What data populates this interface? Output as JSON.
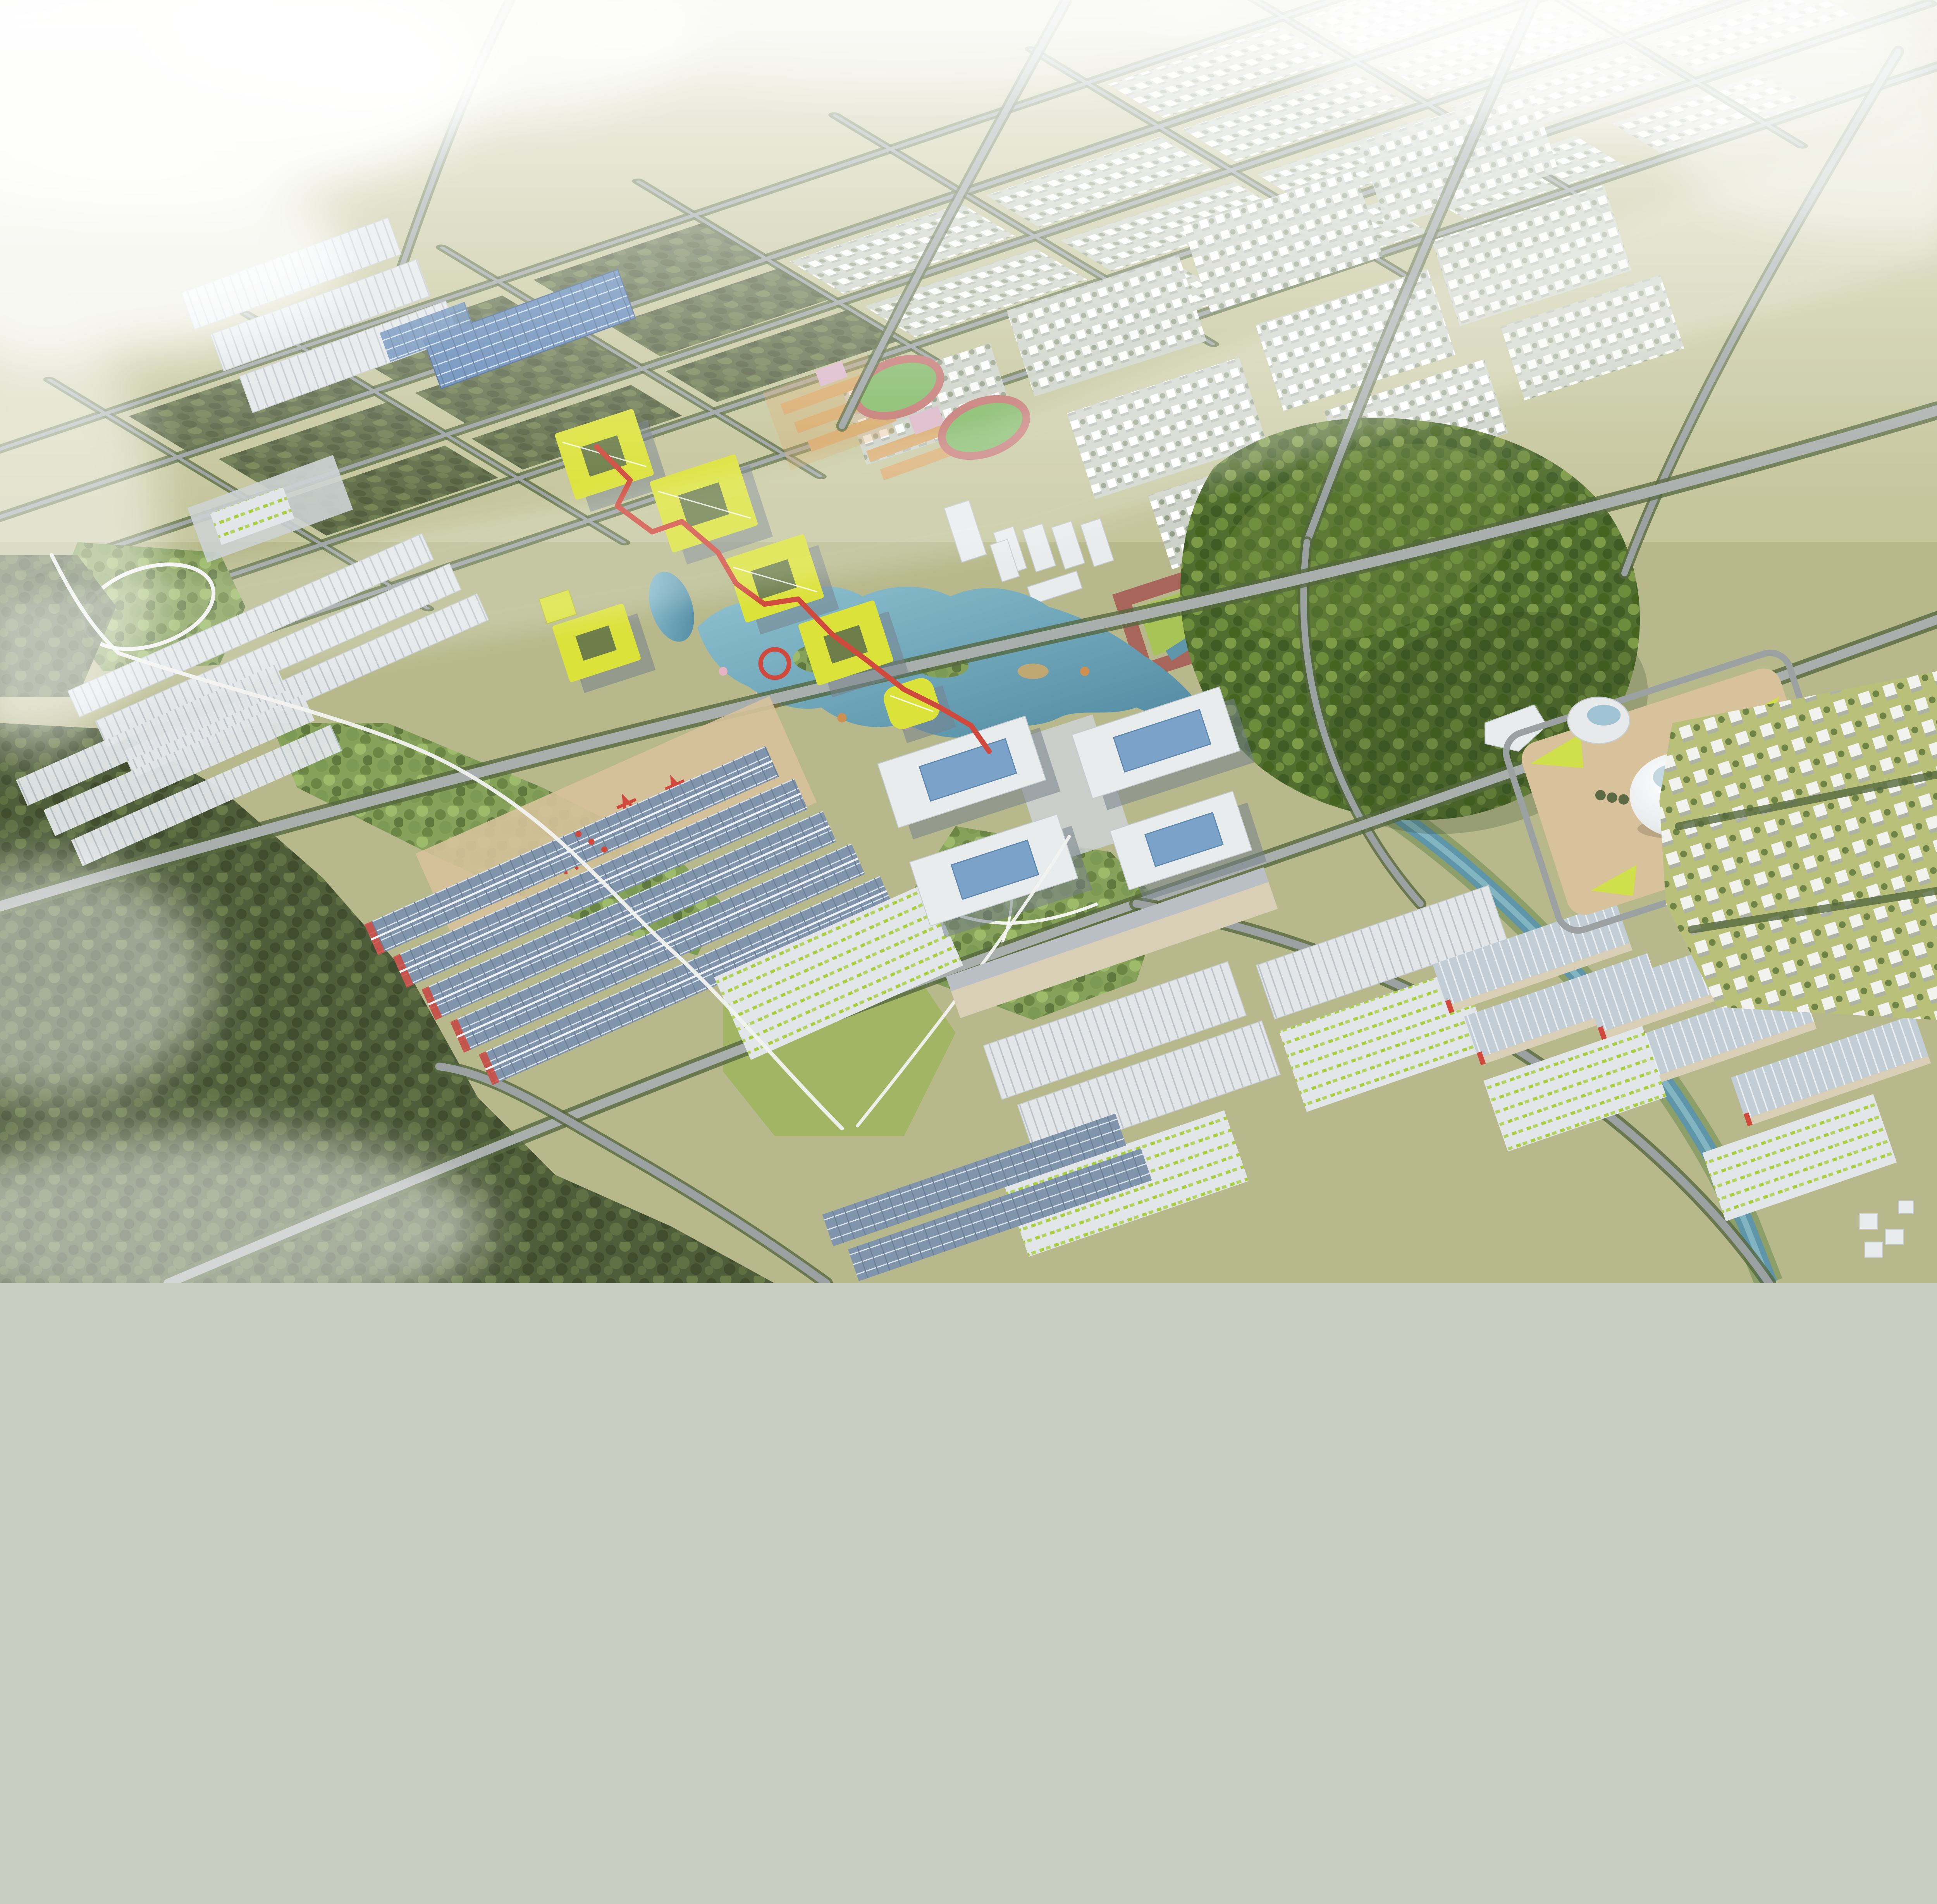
{
  "scene": {
    "description": "Aerial bird's-eye architectural rendering of an eco industrial park masterplan at golden hour, partially veiled by mist. A misty dense forest occupies the west and southwest. A hazy grid of tree-lined boulevards, farmland plots and low white tract housing stretches to the northern horizon. In the center, an innovation campus of gray courtyard buildings with chartreuse-yellow green roofs is threaded by a winding red elevated ribbon walkway with a red ring sculpture, beside a blue lake with wooded islands and autumn trees. A large forested hill rises east of the lake, and a white egg-shaped dome hall with a glass-topped bowl pavilion sits on a tan landscaped plaza further east, next to fields of small white suburban houses. South of the campus lie logistics and manufacturing districts: long warehouses with photovoltaic solar roofs, red gantry cranes in a rail yard, white ridged-roof sheds, and yards filled with rows of yellow-green vehicles. An elevated white monorail guideway and tree-lined arterial roads weave through, and a teal river winds to the southeast. White clouds drift over the northwest corner and the bottom-left forest.",
    "time_of_day": "hazy late afternoon",
    "view": "high oblique aerial, looking north",
    "regions": [
      {
        "id": 0,
        "label": "sky haze over distant city"
      },
      {
        "id": 1,
        "label": "distant tract housing and farmland grid"
      },
      {
        "id": 2,
        "label": "farmland plots with tree hedgerows"
      },
      {
        "id": 3,
        "label": "misty western forest"
      },
      {
        "id": 4,
        "label": "innovation campus with yellow-green roofed courtyard buildings"
      },
      {
        "id": 5,
        "label": "red elevated ribbon walkway with ring sculpture"
      },
      {
        "id": 6,
        "label": "central lake with wooded islands"
      },
      {
        "id": 7,
        "label": "forested hill park"
      },
      {
        "id": 8,
        "label": "dome exhibition hall plaza"
      },
      {
        "id": 9,
        "label": "office campus with blue glass atrium roofs"
      },
      {
        "id": 10,
        "label": "mid-rise residential neighborhoods"
      },
      {
        "id": 11,
        "label": "school campuses with running tracks"
      },
      {
        "id": 12,
        "label": "solar-roof warehouse district with gantry cranes"
      },
      {
        "id": 13,
        "label": "south logistics district with white ridged warehouses"
      },
      {
        "id": 14,
        "label": "southeast warehouse pairs with vehicle yards"
      },
      {
        "id": 15,
        "label": "eastern suburban housing field"
      },
      {
        "id": 16,
        "label": "river corridor to the southeast"
      },
      {
        "id": 17,
        "label": "elevated monorail guideway"
      },
      {
        "id": 18,
        "label": "parks and greenways"
      },
      {
        "id": 19,
        "label": "clouds and mist"
      }
    ],
    "feature_counts": {
      "dome_halls": 1,
      "bowl_pavilions": 1,
      "running_tracks": 2,
      "red_gantry_cranes": 4,
      "red_ring_sculptures": 1,
      "courtyard_buildings_yellow_roof": 6
    }
  },
  "palette": {
    "haze": "#e9ece8",
    "farmland": "#b7b98c",
    "farmland_light": "#c8c9a0",
    "hedge": "#55683f",
    "forest": "#4e5e3b",
    "forest_dark": "#3f4d2e",
    "forest_light": "#6d814a",
    "hill": "#516d2f",
    "hill_light": "#7e9b48",
    "road": "#9aa1a0",
    "road_major": "#a9afad",
    "water": "#6fa8bc",
    "water_deep": "#4e88a0",
    "roof_solar": "#8095ac",
    "roof_solar_line": "#dde5ec",
    "roof_white": "#e2e6e8",
    "roof_ridge_line": "#bcc3c9",
    "wall_cream": "#d9cfb6",
    "wall_gray": "#8b95a0",
    "accent_red": "#cf4a3d",
    "roof_yellow": "#dbe23a",
    "glass_blue": "#7ba3c9",
    "dome_white": "#eceff0",
    "plaza_tan": "#d7c29b",
    "plaza_gray": "#ccd1d3",
    "lawn": "#a8c356",
    "lawn_bright": "#cfe04a",
    "track_red": "#c47772",
    "field_green": "#82ba68",
    "blossom_pink": "#e5b3c4",
    "autumn_orange": "#cf8f4e",
    "vehicle_green": "#a8ce3e",
    "brick": "#a8655a",
    "school_orange": "#d8a96a",
    "monorail": "#f2f3f0",
    "housing_distant": "#cdd2c8",
    "courtyard_green": "#6c7d49"
  }
}
